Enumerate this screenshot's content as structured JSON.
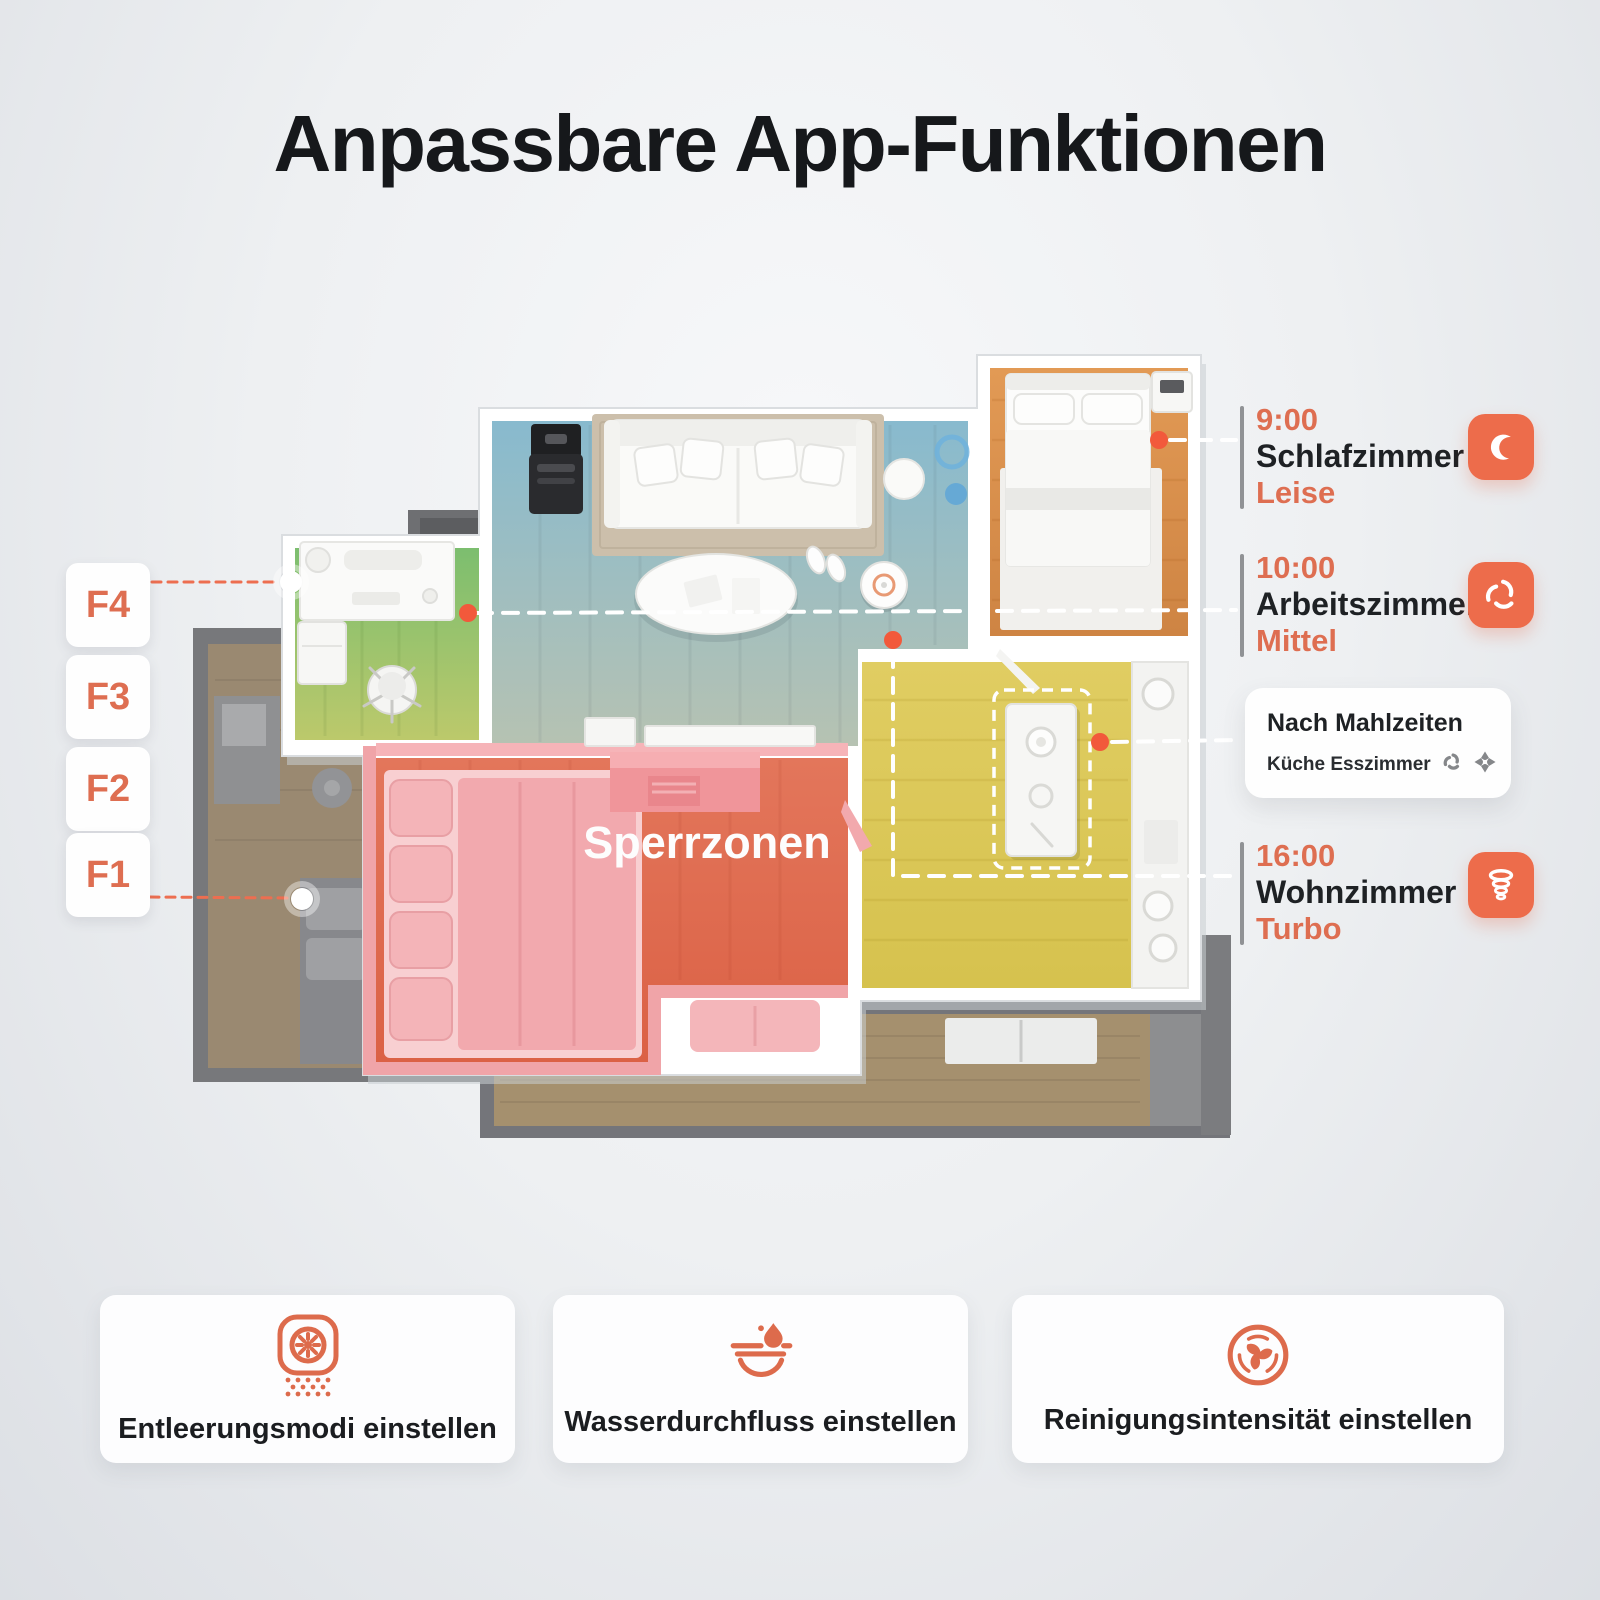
{
  "title": "Anpassbare App-Funktionen",
  "floorplan": {
    "sperrzonen_label": "Sperrzonen",
    "zone_buttons": [
      {
        "label": "F4"
      },
      {
        "label": "F3"
      },
      {
        "label": "F2"
      },
      {
        "label": "F1"
      }
    ]
  },
  "schedule_callouts": {
    "bedroom": {
      "time": "9:00",
      "room": "Schlafzimmer",
      "mode": "Leise",
      "icon": "moon-icon"
    },
    "office": {
      "time": "10:00",
      "room": "Arbeitszimmer",
      "mode": "Mittel",
      "icon": "swirl-icon"
    },
    "kitchen": {
      "title": "Nach Mahlzeiten",
      "subtitle": "Küche Esszimmer",
      "icons": [
        "swirl-icon",
        "mop-icon"
      ]
    },
    "living": {
      "time": "16:00",
      "room": "Wohnzimmer",
      "mode": "Turbo",
      "icon": "tornado-icon"
    }
  },
  "feature_cards": [
    {
      "label": "Entleerungsmodi einstellen",
      "icon": "auto-empty-icon"
    },
    {
      "label": "Wasserdurchfluss einstellen",
      "icon": "water-flow-icon"
    },
    {
      "label": "Reinigungsintensität einstellen",
      "icon": "fan-intensity-icon"
    }
  ],
  "colors": {
    "accent_text": "#DE6E51",
    "icon_background": "#ED6C4B",
    "marker_dot": "#F2593B",
    "title_color": "#16181B"
  }
}
